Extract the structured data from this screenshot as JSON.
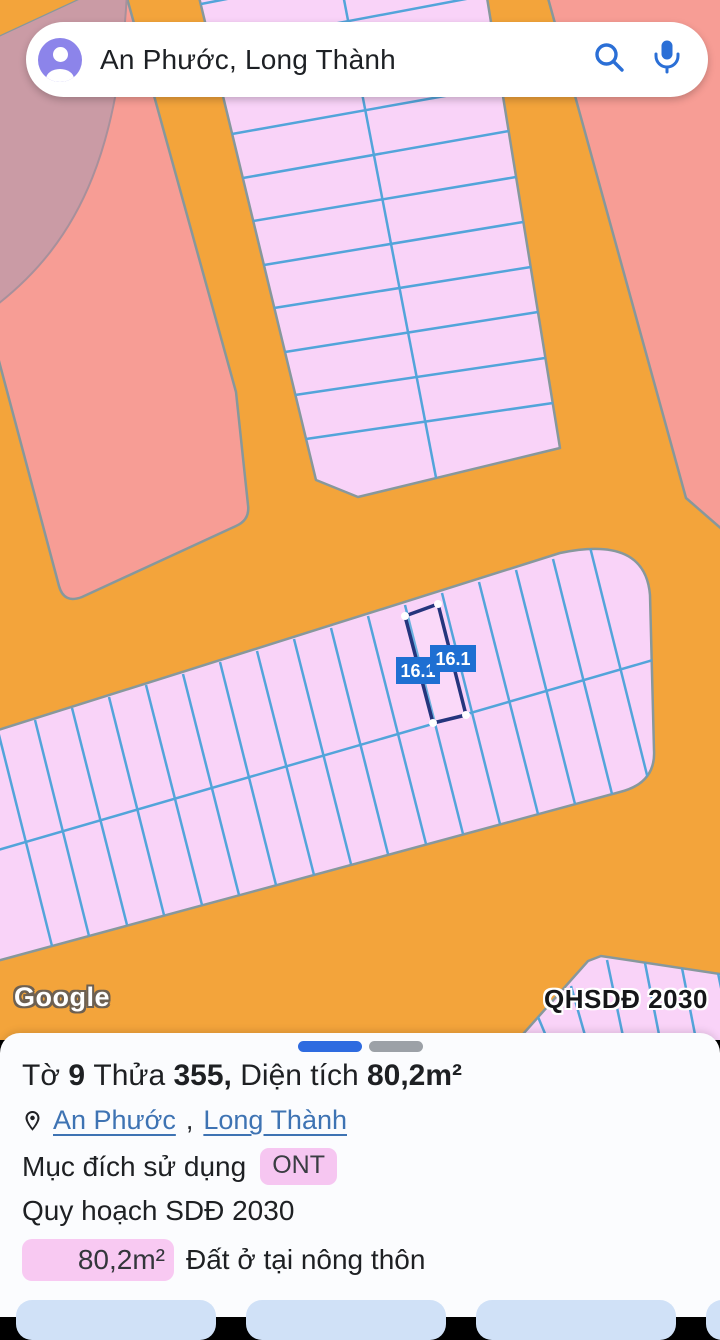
{
  "search": {
    "query": "An Phước, Long Thành",
    "icons": {
      "avatar": "account-avatar",
      "search": "magnifier-icon",
      "microphone": "microphone-icon"
    }
  },
  "map": {
    "google_logo": "Google",
    "overlay_badge": "QHSDĐ 2030",
    "selected_parcel": {
      "labels": [
        "16.1",
        "16.1"
      ]
    },
    "colors": {
      "road_orange": "#F3A43B",
      "zone_salmon": "#F79D95",
      "zone_mauve": "#CA9BA5",
      "parcel_pink": "#F9D3F8",
      "parcel_line_blue": "#53A4DA",
      "block_outline": "#87989C",
      "selection_navy": "#25357D",
      "label_badge_blue": "#1E6FD2"
    }
  },
  "panel": {
    "title": {
      "t1": "Tờ",
      "t2": "9",
      "t3": "Thửa",
      "t4": "355,",
      "t5": "Diện tích",
      "t6": "80,2m²"
    },
    "location": {
      "link1": "An Phước",
      "separator": ",",
      "link2": "Long Thành"
    },
    "land_use": {
      "label": "Mục đích sử dụng",
      "badge": "ONT"
    },
    "planning": "Quy hoạch SDĐ 2030",
    "area": {
      "badge": "80,2m²",
      "description": "Đất ở tại nông thôn"
    },
    "pager": {
      "dots": 2,
      "active_index": 0,
      "active_color": "#2E6BE0",
      "inactive_color": "#9CA1A7"
    }
  }
}
